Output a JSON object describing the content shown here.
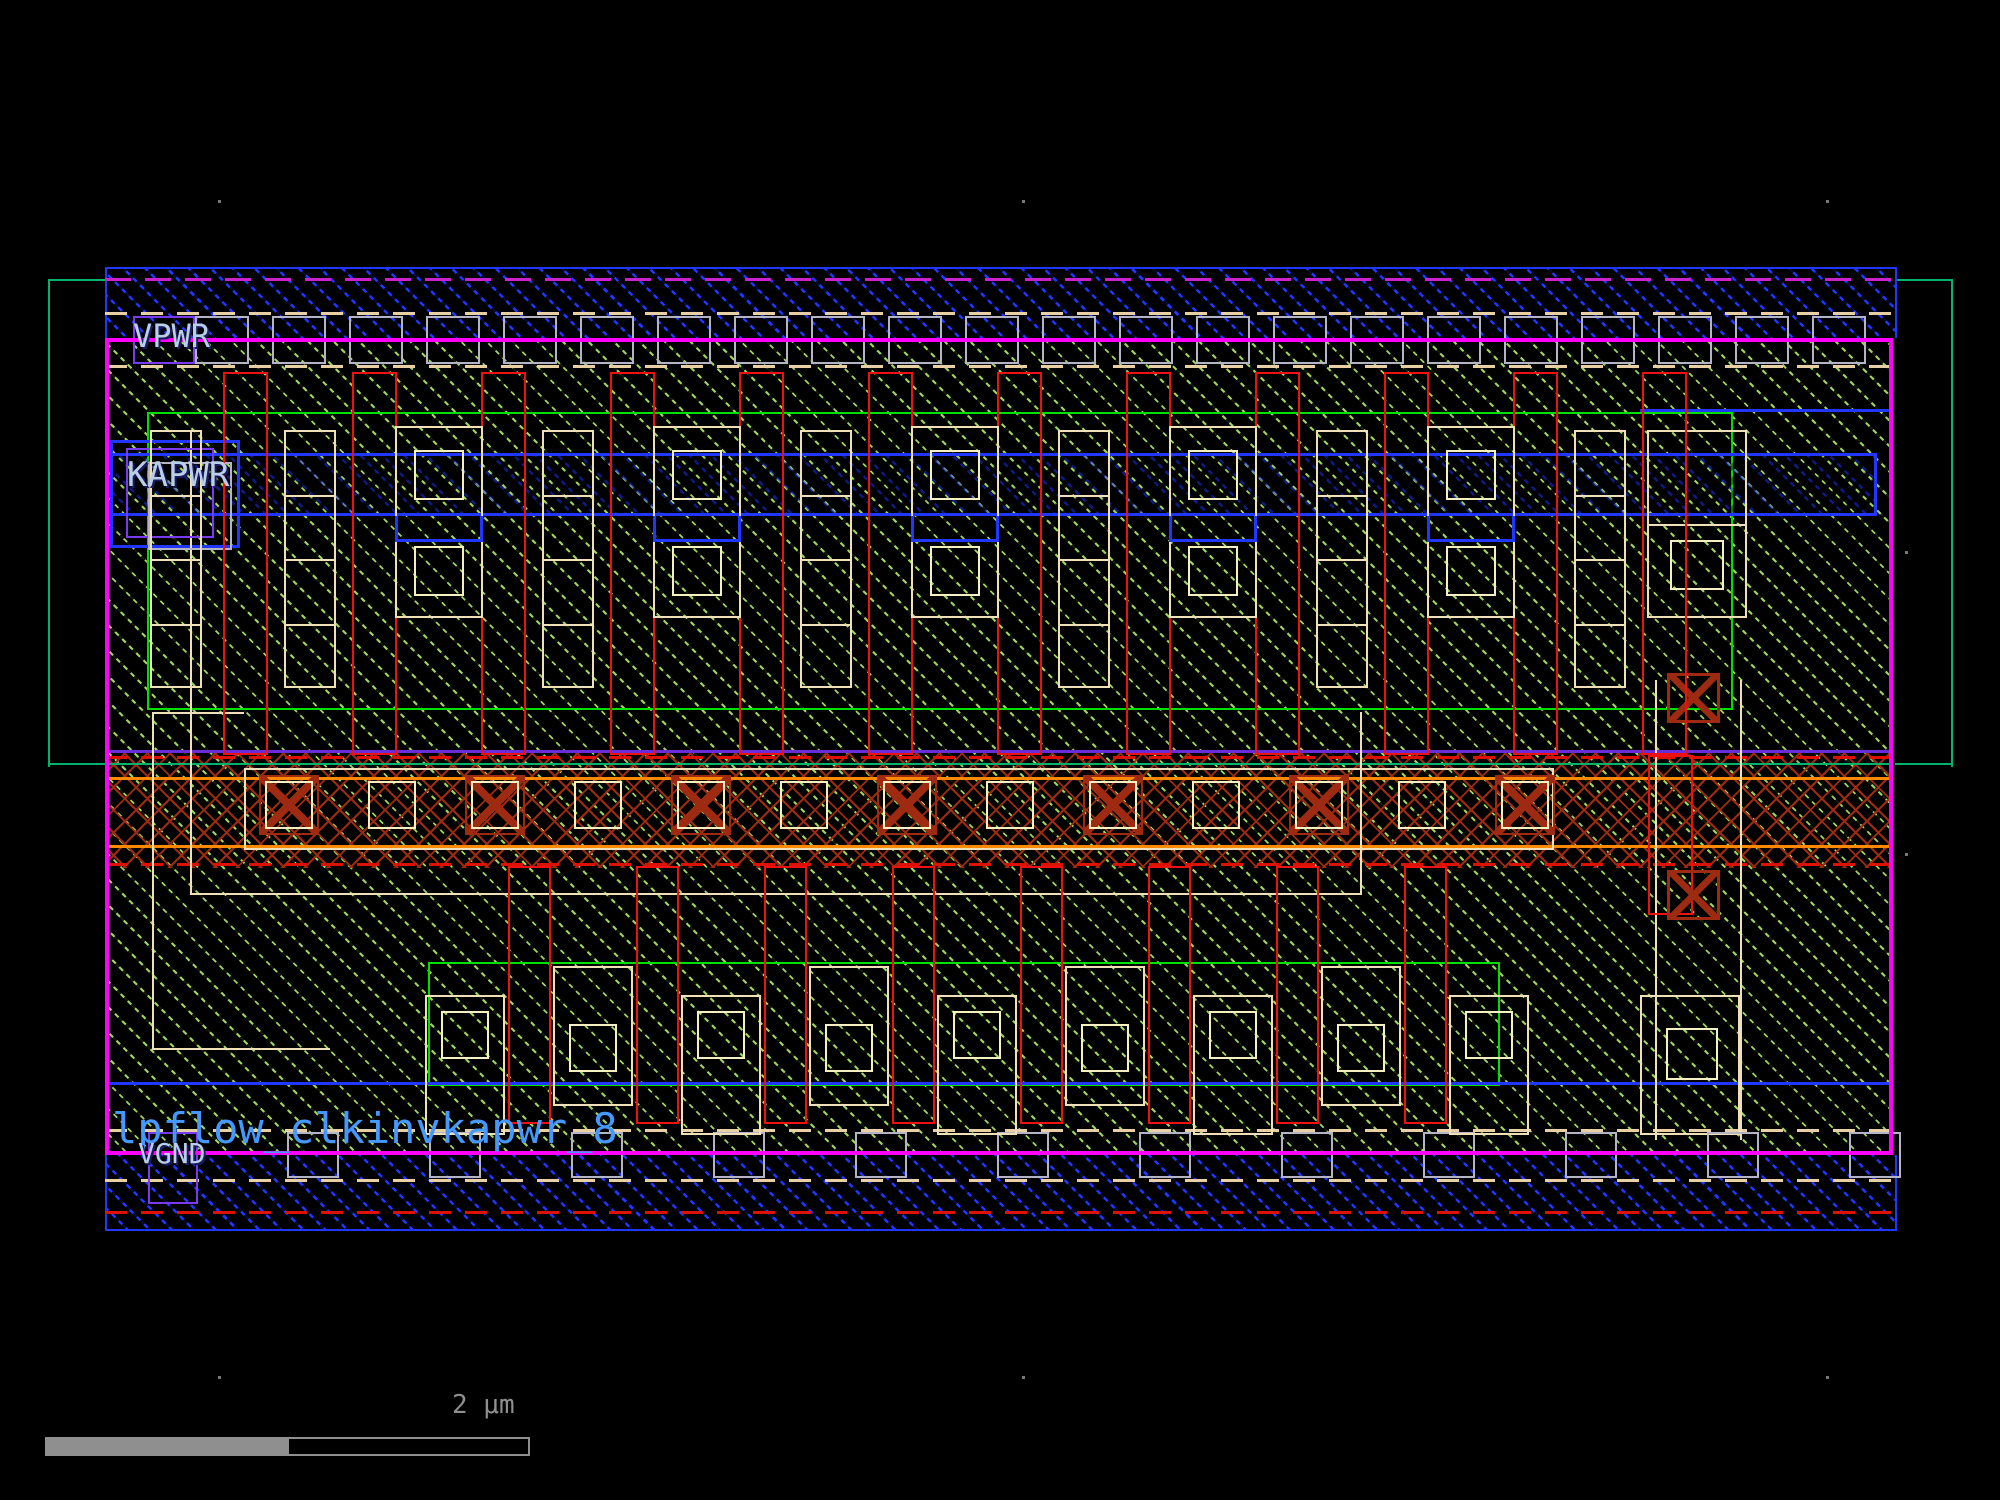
{
  "labels": {
    "vpwr": "VPWR",
    "kapwr": "KAPWR",
    "vgnd": "VGND",
    "cell_name": "lpflow_clkinvkapwr_8"
  },
  "scale_bar": {
    "label": "2 μm"
  },
  "colors": {
    "background": "#000000",
    "metal1_blue": "#2136ff",
    "nwell_green": "#00b36b",
    "boundary_magenta": "#ff00ff",
    "overlap_dash_magenta": "#cc22cc",
    "poly_red": "#ee1111",
    "poly_dark_red": "#9e2a12",
    "diffusion_hatch": "#9fd45f",
    "licon_cream": "#efe0b8",
    "contact_pale_yellow": "#f5f0c0",
    "li1_gray": "#b4b4c4",
    "tap_purple": "#7a3bf0",
    "hv_bright_green": "#00e000",
    "violet_line": "#6a2bd9",
    "orange_line": "#ff8a00",
    "red_dash": "#dd1100",
    "pin_text": "#b9cfe9",
    "net_text": "#4499ff",
    "scalebar_gray": "#8f8f8f"
  },
  "geometry": {
    "top_poly": {
      "count": 12,
      "x0": 223,
      "pitch": 129,
      "w": 45,
      "y": 372,
      "h": 383
    },
    "bottom_poly": {
      "count": 8,
      "x0": 508,
      "pitch": 128,
      "w": 43,
      "y": 866,
      "h": 258
    },
    "top_ladders": {
      "xs": [
        150,
        284,
        542,
        800,
        1058,
        1316,
        1574
      ],
      "w": 52,
      "y": 430,
      "h": 258,
      "rungs": 3
    },
    "top_blocks": {
      "xs": [
        395,
        653,
        911,
        1169,
        1427
      ],
      "w": 88,
      "y": 426,
      "h": 192,
      "sq": 50,
      "sq_dy": [
        24,
        120
      ]
    },
    "mid_contacts": {
      "count": 13,
      "x0": 265,
      "pitch": 103,
      "w": 48,
      "y": 781
    },
    "bottom_blocks": {
      "xs": [
        425,
        553,
        681,
        809,
        937,
        1065,
        1193,
        1321,
        1449
      ],
      "w": 80,
      "h": 140,
      "y_even": 995,
      "y_odd": 966,
      "sq": 48
    },
    "top_rail_taps": {
      "count": 22,
      "x0": 195,
      "pitch": 77,
      "w": 54,
      "y": 316,
      "h": 48
    },
    "bottom_rail_taps": {
      "count": 12,
      "x0": 287,
      "pitch": 142,
      "w": 52,
      "y": 1132,
      "h": 46
    },
    "wire_notches": {
      "y": 516,
      "h": 26
    },
    "ticks": [
      [
        218,
        200
      ],
      [
        1022,
        200
      ],
      [
        1826,
        200
      ],
      [
        1905,
        551
      ],
      [
        1905,
        853
      ],
      [
        218,
        1376
      ],
      [
        1022,
        1376
      ],
      [
        1826,
        1376
      ]
    ]
  }
}
